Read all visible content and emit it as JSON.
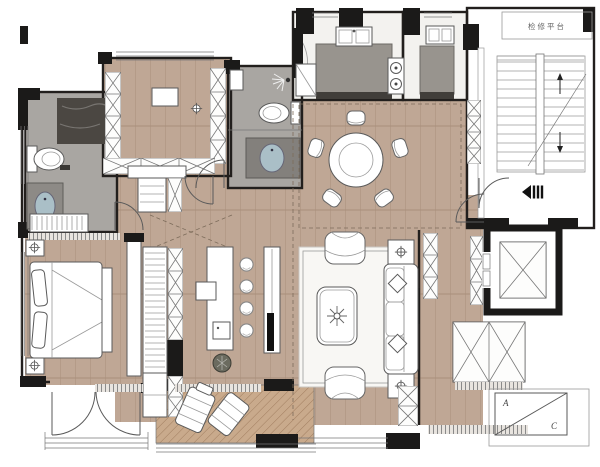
{
  "labels": {
    "maintenance_platform": "检修平台",
    "ac_unit_a": "A",
    "ac_unit_c": "C"
  },
  "colors": {
    "wall": "#1b1a19",
    "wood": "#bfa795",
    "tile": "#a9a6a2",
    "shower": "#4b4742",
    "marble": "#f3f2ef",
    "counter": "#98948e",
    "counter_dark": "#413e3a",
    "basin": "#aabfc7",
    "balcony": "#c9aa8c",
    "rug": "#f8f7f4"
  }
}
